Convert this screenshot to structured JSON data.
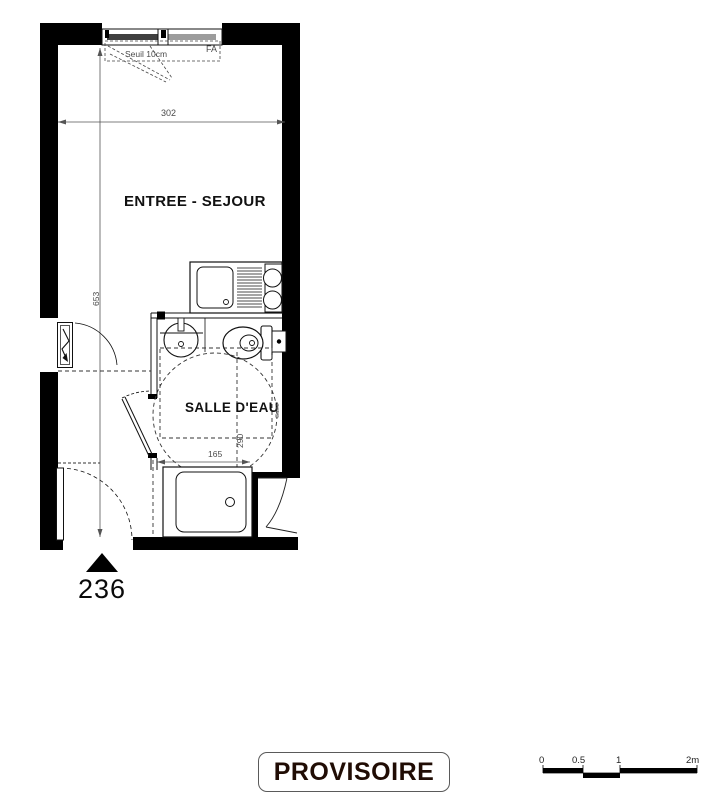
{
  "plan": {
    "rooms": {
      "entree_sejour": "ENTREE - SEJOUR",
      "salle_deau": "SALLE D'EAU"
    },
    "annotations": {
      "seuil": "Seuil 10cm",
      "fa": "FA",
      "duct": "Gaine"
    },
    "dimensions": {
      "living_width": "302",
      "living_height": "653",
      "bath_depth": "290",
      "shower_width": "165"
    },
    "unit_number": "236"
  },
  "stamp": {
    "label": "PROVISOIRE"
  },
  "scale_bar": {
    "labels": [
      "0",
      "0.5",
      "1",
      "2m"
    ]
  },
  "colors": {
    "wall": "#000000",
    "line": "#1a1a1a",
    "dim_text": "#4a4a4a",
    "glazing_dark": "#3f3f3f",
    "glazing_light": "#9c9c9c",
    "stamp_text": "#200c04"
  }
}
